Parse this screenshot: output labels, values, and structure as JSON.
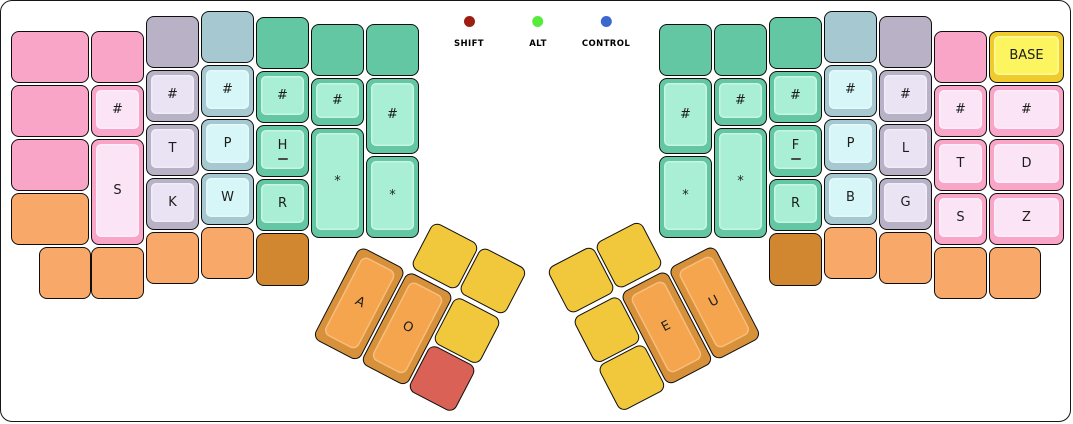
{
  "canvas": {
    "background": "#ffffff",
    "border_color": "#161616"
  },
  "palette": {
    "pink": {
      "rim": "#f8a5c8",
      "plate": "#fce4f7"
    },
    "gray": {
      "rim": "#b9b1c5",
      "plate": "#e9e3f4"
    },
    "blue": {
      "rim": "#a6c8d0",
      "plate": "#d6f6f8"
    },
    "green": {
      "rim": "#63c7a3",
      "plate": "#a8efd5"
    },
    "orange": {
      "rim": "#f8a869",
      "plate": "#fbc99c"
    },
    "brown": {
      "rim": "#d0872f",
      "plate": "#e0a55a"
    },
    "yellow": {
      "rim": "#f1c83c",
      "plate": "#f7da6e"
    },
    "red": {
      "rim": "#da6155",
      "plate": "#e68a80"
    },
    "thumb": {
      "rim": "#d8913b",
      "plate": "#f5a54d"
    },
    "base": {
      "rim": "#f0cb2e",
      "plate": "#fcf55f"
    },
    "label_color": "#1d1d1d"
  },
  "indicators": [
    {
      "label": "SHIFT",
      "color": "#9e1d12",
      "x": 468
    },
    {
      "label": "ALT",
      "color": "#58eb3c",
      "x": 537
    },
    {
      "label": "CONTROL",
      "color": "#3a68ce",
      "x": 605
    }
  ],
  "keyboard": {
    "left_main": [
      {
        "x": 10,
        "y": 30,
        "w": 78,
        "h": 52,
        "c": "pink",
        "label": ""
      },
      {
        "x": 10,
        "y": 84,
        "w": 78,
        "h": 52,
        "c": "pink",
        "label": ""
      },
      {
        "x": 10,
        "y": 138,
        "w": 78,
        "h": 52,
        "c": "pink",
        "label": ""
      },
      {
        "x": 10,
        "y": 192,
        "w": 78,
        "h": 52,
        "c": "orange",
        "label": ""
      },
      {
        "x": 38,
        "y": 246,
        "w": 52,
        "h": 52,
        "c": "orange",
        "label": ""
      },
      {
        "x": 90,
        "y": 30,
        "w": 53,
        "h": 52,
        "c": "pink",
        "label": ""
      },
      {
        "x": 90,
        "y": 84,
        "w": 53,
        "h": 52,
        "c": "pink",
        "label": "#"
      },
      {
        "x": 90,
        "y": 138,
        "w": 53,
        "h": 106,
        "c": "pink",
        "label": "S"
      },
      {
        "x": 90,
        "y": 246,
        "w": 53,
        "h": 52,
        "c": "orange",
        "label": ""
      },
      {
        "x": 145,
        "y": 15,
        "w": 53,
        "h": 52,
        "c": "gray",
        "label": ""
      },
      {
        "x": 145,
        "y": 69,
        "w": 53,
        "h": 52,
        "c": "gray",
        "label": "#"
      },
      {
        "x": 145,
        "y": 123,
        "w": 53,
        "h": 52,
        "c": "gray",
        "label": "T"
      },
      {
        "x": 145,
        "y": 177,
        "w": 53,
        "h": 52,
        "c": "gray",
        "label": "K"
      },
      {
        "x": 145,
        "y": 231,
        "w": 53,
        "h": 52,
        "c": "orange",
        "label": ""
      },
      {
        "x": 200,
        "y": 10,
        "w": 53,
        "h": 52,
        "c": "blue",
        "label": ""
      },
      {
        "x": 200,
        "y": 64,
        "w": 53,
        "h": 52,
        "c": "blue",
        "label": "#"
      },
      {
        "x": 200,
        "y": 118,
        "w": 53,
        "h": 52,
        "c": "blue",
        "label": "P"
      },
      {
        "x": 200,
        "y": 172,
        "w": 53,
        "h": 52,
        "c": "blue",
        "label": "W"
      },
      {
        "x": 200,
        "y": 226,
        "w": 53,
        "h": 52,
        "c": "orange",
        "label": ""
      },
      {
        "x": 255,
        "y": 16,
        "w": 53,
        "h": 52,
        "c": "green",
        "label": ""
      },
      {
        "x": 255,
        "y": 70,
        "w": 53,
        "h": 52,
        "c": "green",
        "label": "#"
      },
      {
        "x": 255,
        "y": 124,
        "w": 53,
        "h": 52,
        "c": "green",
        "label": "H",
        "sub": true
      },
      {
        "x": 255,
        "y": 178,
        "w": 53,
        "h": 52,
        "c": "green",
        "label": "R"
      },
      {
        "x": 255,
        "y": 232,
        "w": 53,
        "h": 53,
        "c": "brown",
        "label": ""
      },
      {
        "x": 310,
        "y": 23,
        "w": 53,
        "h": 52,
        "c": "green",
        "label": ""
      },
      {
        "x": 310,
        "y": 77,
        "w": 53,
        "h": 48,
        "c": "green",
        "label": "#"
      },
      {
        "x": 310,
        "y": 127,
        "w": 53,
        "h": 110,
        "c": "green",
        "label": "*"
      },
      {
        "x": 365,
        "y": 23,
        "w": 53,
        "h": 52,
        "c": "green",
        "label": ""
      },
      {
        "x": 365,
        "y": 77,
        "w": 53,
        "h": 76,
        "c": "green",
        "label": "#"
      },
      {
        "x": 365,
        "y": 155,
        "w": 53,
        "h": 82,
        "c": "green",
        "label": "*"
      }
    ],
    "right_main": [
      {
        "x": 658,
        "y": 23,
        "w": 53,
        "h": 52,
        "c": "green",
        "label": ""
      },
      {
        "x": 658,
        "y": 77,
        "w": 53,
        "h": 76,
        "c": "green",
        "label": "#"
      },
      {
        "x": 658,
        "y": 155,
        "w": 53,
        "h": 82,
        "c": "green",
        "label": "*"
      },
      {
        "x": 713,
        "y": 23,
        "w": 53,
        "h": 52,
        "c": "green",
        "label": ""
      },
      {
        "x": 713,
        "y": 77,
        "w": 53,
        "h": 48,
        "c": "green",
        "label": "#"
      },
      {
        "x": 713,
        "y": 127,
        "w": 53,
        "h": 110,
        "c": "green",
        "label": "*"
      },
      {
        "x": 768,
        "y": 16,
        "w": 53,
        "h": 52,
        "c": "green",
        "label": ""
      },
      {
        "x": 768,
        "y": 70,
        "w": 53,
        "h": 52,
        "c": "green",
        "label": "#"
      },
      {
        "x": 768,
        "y": 124,
        "w": 53,
        "h": 52,
        "c": "green",
        "label": "F",
        "sub": true
      },
      {
        "x": 768,
        "y": 178,
        "w": 53,
        "h": 52,
        "c": "green",
        "label": "R"
      },
      {
        "x": 768,
        "y": 232,
        "w": 53,
        "h": 53,
        "c": "brown",
        "label": ""
      },
      {
        "x": 823,
        "y": 10,
        "w": 53,
        "h": 52,
        "c": "blue",
        "label": ""
      },
      {
        "x": 823,
        "y": 64,
        "w": 53,
        "h": 52,
        "c": "blue",
        "label": "#"
      },
      {
        "x": 823,
        "y": 118,
        "w": 53,
        "h": 52,
        "c": "blue",
        "label": "P"
      },
      {
        "x": 823,
        "y": 172,
        "w": 53,
        "h": 52,
        "c": "blue",
        "label": "B"
      },
      {
        "x": 823,
        "y": 226,
        "w": 53,
        "h": 52,
        "c": "orange",
        "label": ""
      },
      {
        "x": 878,
        "y": 15,
        "w": 53,
        "h": 52,
        "c": "gray",
        "label": ""
      },
      {
        "x": 878,
        "y": 69,
        "w": 53,
        "h": 52,
        "c": "gray",
        "label": "#"
      },
      {
        "x": 878,
        "y": 123,
        "w": 53,
        "h": 52,
        "c": "gray",
        "label": "L"
      },
      {
        "x": 878,
        "y": 177,
        "w": 53,
        "h": 52,
        "c": "gray",
        "label": "G"
      },
      {
        "x": 878,
        "y": 231,
        "w": 53,
        "h": 52,
        "c": "orange",
        "label": ""
      },
      {
        "x": 933,
        "y": 30,
        "w": 53,
        "h": 52,
        "c": "pink",
        "label": ""
      },
      {
        "x": 933,
        "y": 84,
        "w": 53,
        "h": 52,
        "c": "pink",
        "label": "#"
      },
      {
        "x": 933,
        "y": 138,
        "w": 53,
        "h": 52,
        "c": "pink",
        "label": "T"
      },
      {
        "x": 933,
        "y": 192,
        "w": 53,
        "h": 52,
        "c": "pink",
        "label": "S"
      },
      {
        "x": 933,
        "y": 246,
        "w": 53,
        "h": 52,
        "c": "orange",
        "label": ""
      },
      {
        "x": 988,
        "y": 30,
        "w": 75,
        "h": 52,
        "c": "base",
        "label": "BASE"
      },
      {
        "x": 988,
        "y": 84,
        "w": 75,
        "h": 52,
        "c": "pink",
        "label": "#"
      },
      {
        "x": 988,
        "y": 138,
        "w": 75,
        "h": 52,
        "c": "pink",
        "label": "D"
      },
      {
        "x": 988,
        "y": 192,
        "w": 75,
        "h": 52,
        "c": "pink",
        "label": "Z"
      },
      {
        "x": 988,
        "y": 246,
        "w": 52,
        "h": 52,
        "c": "orange",
        "label": ""
      }
    ],
    "left_thumb": {
      "x": 385,
      "y": 195,
      "angle": 27.5,
      "keys": [
        {
          "x": 54,
          "y": 0,
          "w": 52,
          "h": 52,
          "c": "yellow",
          "label": ""
        },
        {
          "x": 108,
          "y": 0,
          "w": 52,
          "h": 52,
          "c": "yellow",
          "label": ""
        },
        {
          "x": 0,
          "y": 56,
          "w": 52,
          "h": 104,
          "c": "thumb",
          "label": "A"
        },
        {
          "x": 54,
          "y": 56,
          "w": 52,
          "h": 104,
          "c": "thumb",
          "label": "O"
        },
        {
          "x": 108,
          "y": 56,
          "w": 52,
          "h": 52,
          "c": "yellow",
          "label": ""
        },
        {
          "x": 108,
          "y": 110,
          "w": 52,
          "h": 52,
          "c": "red",
          "label": ""
        }
      ]
    },
    "right_thumb": {
      "x": 545,
      "y": 268,
      "angle": -27.5,
      "keys": [
        {
          "x": 0,
          "y": 0,
          "w": 52,
          "h": 52,
          "c": "yellow",
          "label": ""
        },
        {
          "x": 54,
          "y": 0,
          "w": 52,
          "h": 52,
          "c": "yellow",
          "label": ""
        },
        {
          "x": 0,
          "y": 56,
          "w": 52,
          "h": 52,
          "c": "yellow",
          "label": ""
        },
        {
          "x": 54,
          "y": 56,
          "w": 52,
          "h": 104,
          "c": "thumb",
          "label": "E"
        },
        {
          "x": 108,
          "y": 56,
          "w": 52,
          "h": 104,
          "c": "thumb",
          "label": "U"
        },
        {
          "x": 0,
          "y": 110,
          "w": 52,
          "h": 52,
          "c": "yellow",
          "label": ""
        }
      ]
    }
  }
}
